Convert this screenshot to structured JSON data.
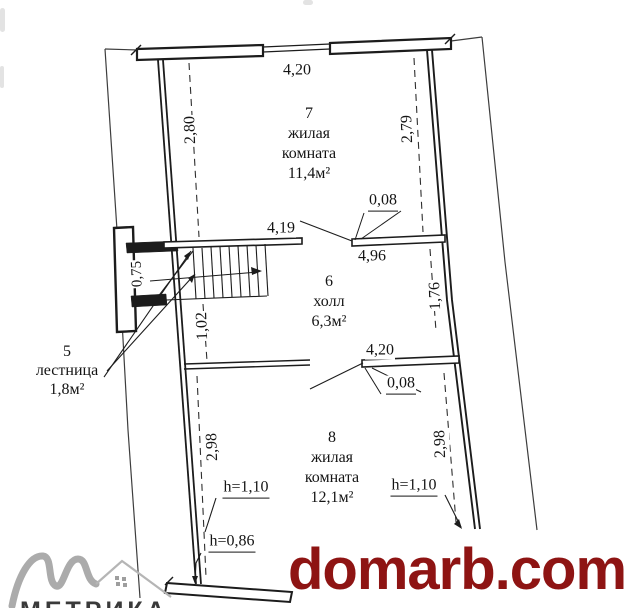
{
  "watermark": {
    "text": "domarb.com"
  },
  "logo": {
    "caption": "МЕТРИКА"
  },
  "rooms": {
    "r7": {
      "number": "7",
      "name1": "жилая",
      "name2": "комната",
      "area": "11,4м²"
    },
    "r6": {
      "number": "6",
      "name1": "холл",
      "area": "6,3м²"
    },
    "r8": {
      "number": "8",
      "name1": "жилая",
      "name2": "комната",
      "area": "12,1м²"
    },
    "r5": {
      "number": "5",
      "name1": "лестница",
      "area": "1,8м²"
    }
  },
  "dims": {
    "top_width": "4,20",
    "r7_left": "2,80",
    "r7_right": "2,79",
    "wall_t_top": "0,08",
    "stair_width": "4,19",
    "hall_width": "4,96",
    "hall_right": "1,76",
    "niche": "0,75",
    "stair_side": "1,02",
    "r8_door_wall": "4,20",
    "wall_t_mid": "0,08",
    "r8_left": "2,98",
    "r8_right": "2,98",
    "h_left": "h=1,10",
    "h_right": "h=1,10",
    "h_bottom": "h=0,86"
  },
  "colors": {
    "watermark_red": "#8e1413",
    "ink": "#1c1c1c",
    "logo_gray": "#ababab"
  }
}
